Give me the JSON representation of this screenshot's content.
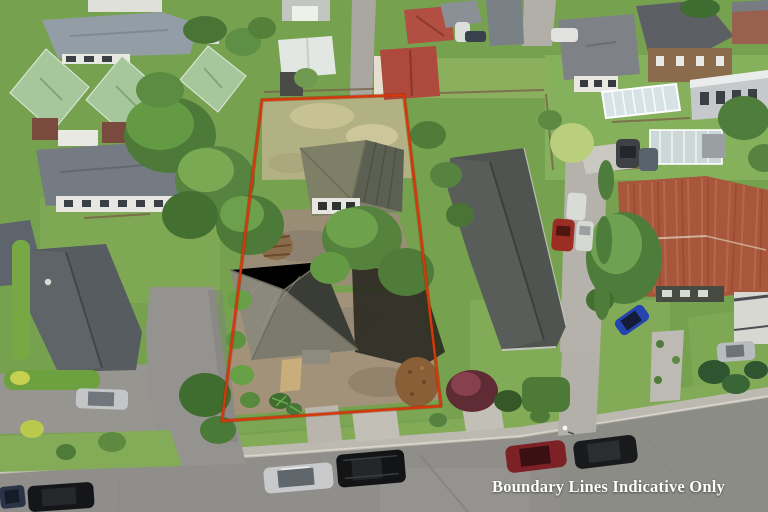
{
  "photo": {
    "kind": "aerial-drone-photo",
    "subject": "residential neighbourhood with a vacant section outlined in red"
  },
  "caption": {
    "text": "Boundary Lines Indicative Only"
  },
  "boundary": {
    "points": "262,100 404,95 441,406 222,421",
    "color": "#d5380a"
  },
  "colors": {
    "caption_text": "#ffffff",
    "boundary_line": "#d5380a",
    "asphalt": "#8f8e8a",
    "footpath": "#bcb9b1",
    "grass_base": "#76a24f",
    "grass_light": "#86b15c",
    "dry_grass": "#b2b183",
    "dirt": "#a3927a",
    "canopy_dark": "#4d7a38",
    "canopy_mid": "#659a45",
    "canopy_light": "#7fb257",
    "green_roof": "#a6c79c",
    "terracotta_roof": "#b04f42",
    "rust_roof": "#a8563c",
    "slate_roof": "#565c60",
    "shingle_roof": "#8b897b"
  }
}
